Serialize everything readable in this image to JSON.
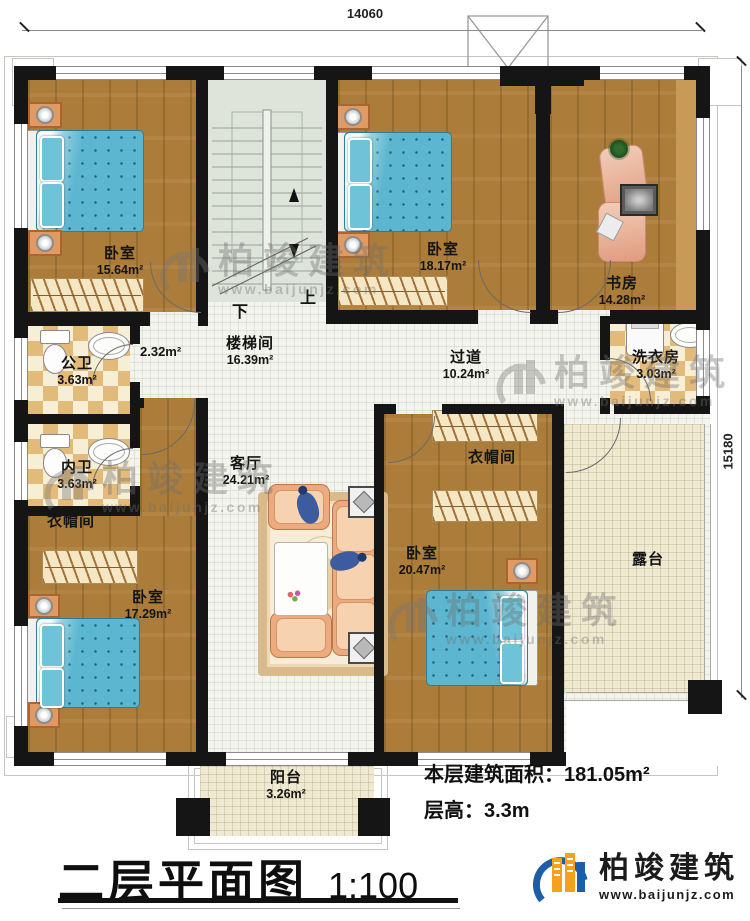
{
  "header": {
    "dim_top": "14060",
    "dim_right": "15180"
  },
  "stairs": {
    "up": "上",
    "down": "下"
  },
  "rooms": {
    "bedroom1": {
      "name": "卧室",
      "area": "15.64m²"
    },
    "stairwell": {
      "name": "楼梯间",
      "area": "16.39m²"
    },
    "bedroom2": {
      "name": "卧室",
      "area": "18.17m²"
    },
    "study": {
      "name": "书房",
      "area": "14.28m²"
    },
    "public_bath": {
      "name": "公卫",
      "area": "3.63m²"
    },
    "inner_bath": {
      "name": "内卫",
      "area": "3.63m²"
    },
    "niche": {
      "area": "2.32m²"
    },
    "closet1": {
      "name": "衣帽间"
    },
    "bedroom3": {
      "name": "卧室",
      "area": "17.29m²"
    },
    "living": {
      "name": "客厅",
      "area": "24.21m²"
    },
    "hallway": {
      "name": "过道",
      "area": "10.24m²"
    },
    "laundry": {
      "name": "洗衣房",
      "area": "3.03m²"
    },
    "closet2": {
      "name": "衣帽间"
    },
    "bedroom4": {
      "name": "卧室",
      "area": "20.47m²"
    },
    "terrace": {
      "name": "露台"
    },
    "balcony": {
      "name": "阳台",
      "area": "3.26m²"
    }
  },
  "info": {
    "area_label": "本层建筑面积：",
    "area_value": "181.05m²",
    "height_label": "层高：",
    "height_value": "3.3m"
  },
  "title": {
    "main": "二层平面图",
    "scale": "1:100"
  },
  "watermark": {
    "brand": "柏竣建筑",
    "url": "www.baijunjz.com"
  },
  "logo": {
    "brand": "柏竣建筑",
    "url": "www.baijunjz.com"
  },
  "colors": {
    "wood": "#ac7d3a",
    "tile": "#e2ba7a",
    "wall": "#151515",
    "bed_blue": "#5cb6cf",
    "logo_blue": "#1c5fa8",
    "logo_orange": "#f6a01d"
  }
}
